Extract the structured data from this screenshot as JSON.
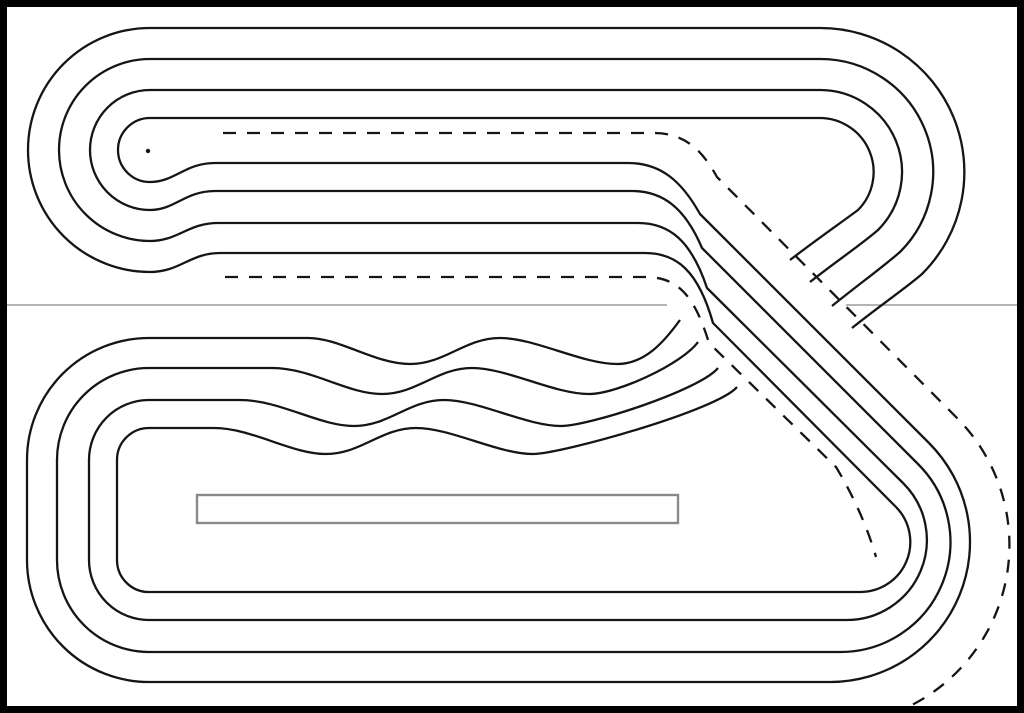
{
  "canvas": {
    "width_px": 1024,
    "height_px": 713
  },
  "colors": {
    "bg": "#ffffff",
    "line": "#151515",
    "frame": "#000000",
    "split": "#9b9b9b",
    "box": "#8a8a8a"
  },
  "drawing": {
    "kind": "four-lane crossover race track template, black line art",
    "lane_count": 4,
    "dashed_guide_count": 2,
    "page_split_line_y": 305,
    "start_box_present": true,
    "turn_center_dot": {
      "x": 148,
      "y": 151
    }
  }
}
